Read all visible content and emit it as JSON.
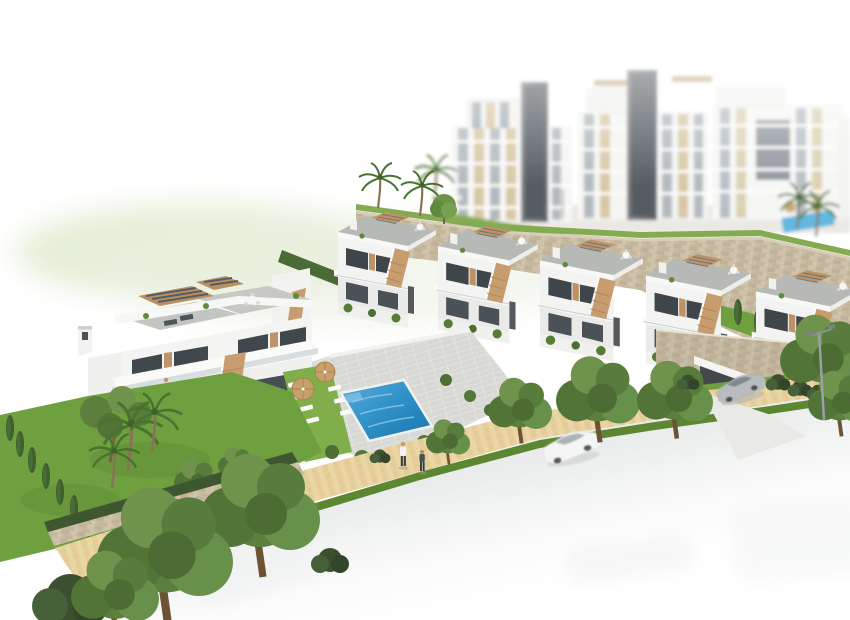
{
  "meta": {
    "image_type": "3d-architectural-render",
    "subject": "Aerial 3D rendering of a new-build Mediterranean residential development",
    "aria_label": "Aerial 3D architectural rendering of a white residential development: a row of five townhouses with grey roof terraces, tan louvred pergolas and external staircases, a two-unit villa on the left, a communal rectangular swimming pool with white sun loungers and two tan parasols, stone retaining walls, lawns with palms, pines, olive trees and cypresses, a sand-coloured paver sidewalk with two pedestrians, a street fading to white with a parked white sedan, a silver coupe on a garage driveway, a street lamp, and large blurred white apartment blocks with beige panels in the background"
  },
  "palette": {
    "background": "#ffffff",
    "building_white": "#f4f4f2",
    "building_shadow": "#dcdcd9",
    "wood_accent": "#c2976a",
    "window_glass": "#414950",
    "roof_deck_grey": "#b6b9b5",
    "stone_wall": "#c6baa1",
    "grass_bright": "#6fa03f",
    "grass_verge": "#5c8631",
    "foliage_dark": "#466332",
    "pool_blue": "#2f8fc6",
    "pool_blue_light": "#5fb7de",
    "paver_tan": "#e7d1a0",
    "road_grey": "#e2e4e6",
    "car_white": "#f4f5f4",
    "car_silver": "#b9bcbe",
    "parasol_tan": "#c8a06b",
    "lamp_grey": "#9aa0a3"
  },
  "scene": {
    "apartment_complex": {
      "buildings": 3,
      "floors": 6,
      "style": "white facades, beige infill panels, grey glazing, dark lift towers, roof pergolas",
      "treatment": "blurred depth-of-field background on a plateau with small pool and palms"
    },
    "townhouse_row": {
      "units": 5,
      "features": "grey roof decks, tan louvred roof pergolas, external tan staircases, dark glazing, terrace slabs, private walled gardens with hedges"
    },
    "villa": {
      "units": 2,
      "features": "stepped white volumes, chimney, two louvred pergolas, roof loungers, round table set, balcony dining table, external tan staircase, glass balustrades"
    },
    "pool_area": {
      "pool_shape": "rectangular",
      "loungers": 8,
      "parasols": 2,
      "deck": "grey paver deck with lawn strip and perimeter bushes"
    },
    "landscaping": {
      "palms": 7,
      "olive_trees": 10,
      "cypresses": 12,
      "pine_trees": 1,
      "lawns": 3,
      "stone_retaining_walls": 3,
      "green_blur_haze": true
    },
    "street": {
      "sidewalk": "sand-coloured paver path with dark grass verge",
      "pedestrians": 2,
      "street_lamps": 1,
      "parked_cars": [
        "white sedan on road",
        "silver coupe on garage driveway"
      ],
      "faded_cars": 3,
      "garage": "dark opening in stone retaining wall with concrete driveway crossing the sidewalk",
      "road": "light grey asphalt fading to white at the bottom edge"
    }
  }
}
